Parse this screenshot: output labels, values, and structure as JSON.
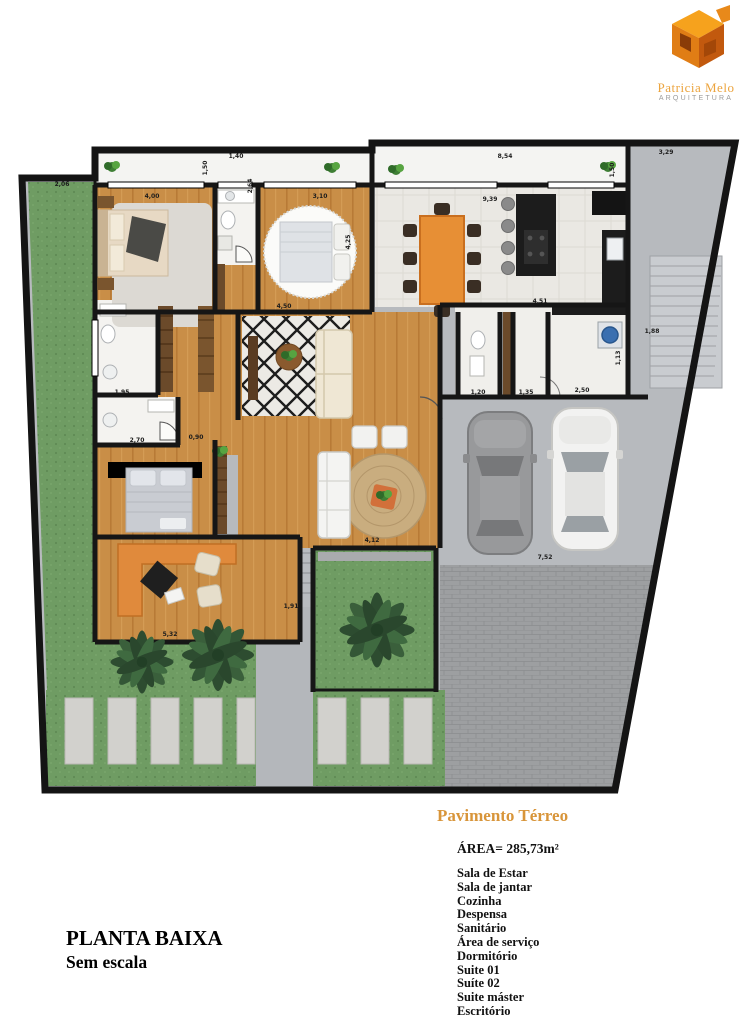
{
  "logo": {
    "name": "Patricia Melo",
    "subtitle": "ARQUITETURA"
  },
  "legend": {
    "heading": "Pavimento Térreo",
    "area": "ÁREA= 285,73m²",
    "rooms": [
      "Sala de Estar",
      "Sala de jantar",
      "Cozinha",
      "Despensa",
      "Sanitário",
      "Área de serviço",
      "Dormitório",
      "Suite 01",
      "Suíte 02",
      "Suite máster",
      "Escritório"
    ]
  },
  "footer": {
    "title": "PLANTA BAIXA",
    "subtitle": "Sem escala"
  },
  "plan": {
    "dimensions": [
      "2,06",
      "4,00",
      "1,50",
      "1,40",
      "2,64",
      "3,10",
      "8,54",
      "9,39",
      "1,50",
      "3,29",
      "4,50",
      "4,25",
      "4,51",
      "1,88",
      "1,95",
      "2,70",
      "0,90",
      "1,20",
      "1,35",
      "2,50",
      "1,13",
      "5,32",
      "1,91",
      "4,12",
      "7,52"
    ],
    "colors": {
      "grass": "#6f9c63",
      "wood": "#c98e47",
      "marble": "#eae8e3",
      "concrete": "#b7babe",
      "pavers": "#9d9fa1",
      "wall": "#161616",
      "accent_orange": "#e78f35",
      "logo_orange": "#f6a21d",
      "heading_gold": "#d8953a"
    }
  }
}
